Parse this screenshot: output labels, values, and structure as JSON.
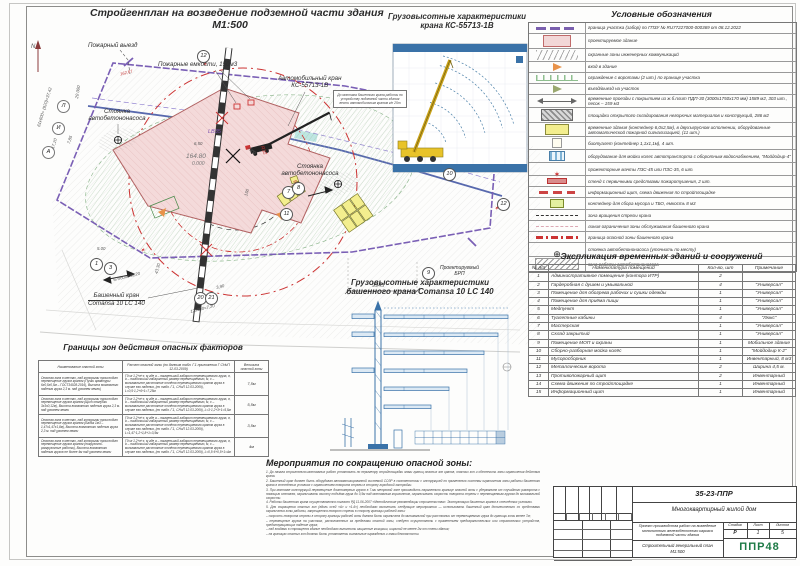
{
  "plan": {
    "title": "Стройгенплан на возведение подземной части здания",
    "scale": "М1:500",
    "labels": {
      "fire_exit": "Пожарный выезд",
      "fire_tanks": "Пожарные емкости, 150м3",
      "auto_crane_1": "Автомобильный кран",
      "auto_crane_2": "КС-55713-1В",
      "pump_parking_1": "Стоянка",
      "pump_parking_2": "автобетононасоса",
      "pump_parking2_1": "Стоянка",
      "pump_parking2_2": "автобетононасоса",
      "tower_crane_1": "Башенный кран",
      "tower_crane_2": "Comansa 10 LC 140",
      "brp_1": "Проектируемый",
      "brp_2": "БРП",
      "note": "До монтажа башенного крана работы по устройству подземной части здания вести автомобильным краном г/п 25т"
    },
    "marks": {
      "elev": "164.80",
      "zero": "0.000",
      "lb": "LB35",
      "r1": "R32",
      "r2": "R49,5",
      "red_elev": "162,67",
      "rail_len": "150"
    },
    "dims": {
      "d1": "61х600+ (920)=37,42",
      "d2": "20 000",
      "d3": "17,20",
      "d4": "9,40",
      "d5": "7,85",
      "d6": "5.00",
      "d7": "67х600=40,20",
      "d8": "43,30",
      "d9": "3,90",
      "d10": "12х600=7,20",
      "d11": "9945",
      "d12": "6,50",
      "d13": "7500"
    },
    "bubbles": {
      "n12": "12",
      "n10": "10",
      "n9": "9",
      "n11": "11",
      "n7": "7",
      "n8": "8",
      "n1": "1",
      "n3": "3",
      "n20": "20",
      "n21": "21",
      "axis_a": "А",
      "axis_i": "И",
      "axis_l": "Л"
    }
  },
  "truck_chart": {
    "title1": "Грузовысотные характеристики",
    "title2": "крана КС-55713-1В"
  },
  "tower_chart": {
    "title1": "Грузовысотные характеристики",
    "title2": "башенного крана Comansa 10 LC 140"
  },
  "legend": {
    "title": "Условные обозначения",
    "rows": [
      {
        "sym": "sym-boundary",
        "text": "граница участка (забор) по ГПЗУ № RU77227000-000369 от 08.12.2022"
      },
      {
        "sym": "sym-building",
        "text": "проектируемое здание"
      },
      {
        "sym": "sym-utility",
        "text": "охранные зоны инженерных коммуникаций"
      },
      {
        "sym": "sym-entry",
        "text": "вход в здание"
      },
      {
        "sym": "sym-fence",
        "text": "ограждение с воротами (2 шт.) по границе участка"
      },
      {
        "sym": "sym-exit",
        "text": "въезд/выезд на участок"
      },
      {
        "sym": "sym-roads",
        "text": "временные проезды с покрытием из ж.б.плит ПДП-30 (3000х1750х170 мм) 1589 м2, 303 шт., песок – 159 м3"
      },
      {
        "sym": "sym-storage",
        "text": "площадки открытого складирования негорючих материалов и конструкций, 286 м2"
      },
      {
        "sym": "sym-tempbld",
        "text": "временные здания (контейнер 6,0х2,5м), в двухъярусном исполнении, оборудованные автоматической пожарной сигнализацией, (11 шт.)"
      },
      {
        "sym": "sym-biotoilet",
        "text": "биотуалет (контейнер 1,1х1,1м), 4 шт."
      },
      {
        "sym": "sym-wash",
        "text": "оборудование для мойки колес автотранспорта с оборотным водоснабжением, \"Мойдодыр-4\""
      },
      {
        "sym": "sym-light",
        "text": "прожекторные мачты ПЗС-45 или ПЗС-35, 6 шт."
      },
      {
        "sym": "sym-firestand",
        "text": "стенд с первичными средствами пожаротушения, 2 шт."
      },
      {
        "sym": "sym-info",
        "text": "информационный щит, схема движения по стройплощадке"
      },
      {
        "sym": "sym-waste",
        "text": "контейнер для сбора мусора и ТБО, емкость 8 м3"
      },
      {
        "sym": "sym-slew",
        "text": "зона вращения стрелы крана"
      },
      {
        "sym": "sym-limit",
        "text": "линия ограничения зоны обслуживания башенного крана"
      },
      {
        "sym": "sym-danger",
        "text": "граница опасной зоны башенного крана"
      },
      {
        "sym": "sym-pumppark",
        "text": "стоянка автобетононасоса (уточнить по месту)"
      },
      {
        "sym": "sym-pumpzone",
        "text": "зона работы автобетононасоса"
      }
    ]
  },
  "explication": {
    "title": "Экспликация временных зданий и сооружений",
    "headers": [
      "№ п/п",
      "Номенклатура помещений",
      "Кол-во, шт",
      "Примечание"
    ],
    "rows": [
      {
        "num": "1",
        "name": "Административное помещение (контора ИТР)",
        "qty": "2",
        "note": ""
      },
      {
        "num": "2",
        "name": "Гардеробная с душем и умывальной",
        "qty": "4",
        "note": "\"Универсал\""
      },
      {
        "num": "3",
        "name": "Помещение для обогрева рабочих и сушки одежды",
        "qty": "1",
        "note": "\"Универсал\""
      },
      {
        "num": "4",
        "name": "Помещение для приёма пищи",
        "qty": "1",
        "note": "\"Универсал\""
      },
      {
        "num": "5",
        "name": "Медпункт",
        "qty": "1",
        "note": "\"Универсал\""
      },
      {
        "num": "6",
        "name": "Туалетные кабины",
        "qty": "4",
        "note": "\"Люкс\""
      },
      {
        "num": "7",
        "name": "Мастерская",
        "qty": "1",
        "note": "\"Универсал\""
      },
      {
        "num": "8",
        "name": "Склад закрытый",
        "qty": "1",
        "note": "\"Универсал\""
      },
      {
        "num": "9",
        "name": "Помещение МОП и охраны",
        "qty": "1",
        "note": "Мобильное здание"
      },
      {
        "num": "10",
        "name": "Сборно-разборная мойка колёс",
        "qty": "1",
        "note": "\"Мойдодыр К-2\""
      },
      {
        "num": "11",
        "name": "Мусоросборник",
        "qty": "1",
        "note": "Инвентарный, 8 м3"
      },
      {
        "num": "12",
        "name": "Металлические ворота",
        "qty": "2",
        "note": "Ширина 4,5 м."
      },
      {
        "num": "13",
        "name": "Противопожарный щит",
        "qty": "2",
        "note": "Инвентарный"
      },
      {
        "num": "14",
        "name": "Схема движения по стройплощадке",
        "qty": "1",
        "note": "Инвентарный"
      },
      {
        "num": "15",
        "name": "Информационный щит",
        "qty": "1",
        "note": "Инвентарный"
      }
    ]
  },
  "hazard_table": {
    "title": "Границы зон действия опасных факторов",
    "headers": [
      "Наименование опасной зоны",
      "Расчет опасной зоны (по данным табл. Г.1 приложения Г СНиП 12-03-2009)",
      "Величина опасной зоны"
    ],
    "rows": [
      {
        "name": "Опасная зона в местах, над которыми происходит перемещение грузов краном (Пучки арматуры 6х0,5х0,5м – ГОСТ34028-2016), Высота возможного падения груза 2,3 м. над уровнем земли)",
        "calc": "Г0=а·1,2+в+х, м  где а – наименьший габарит перемещаемого груза, в, b – наибольший габаритный размер перемещаемого, м, х – минимальное расстояние отлёта перемещаемого краном груза в случае его падения, (по табл. Г.1, СНиП 12-03-2009), L=0,5·1,2+6+1=7,25м",
        "value": "7,5м"
      },
      {
        "name": "Опасная зона в местах, над которыми происходит перемещение грузов краном (Щит опалубки 3х3х0,12м), Высота возможного падения груза 2,3 м. над уровнем земли",
        "calc": "Г0=а·1,2+в+х, м  где а – наименьший габарит перемещаемого груза, в, b – наибольший габаритный размер перемещаемого, м, х – минимальное расстояние отлёта перемещаемого краном груза в случае его падения, (по табл. Г.1, СНиП 12-03-2009), L=3·1,2+3+1=5,5м",
        "value": "5,5м"
      },
      {
        "name": "Опасная зона в местах, над которыми происходит перемещение грузов краном (Бадья 1м3 – 1,47х1,47х1,8м), Высота возможного падения груза 2,3 м. над уровнем земли",
        "calc": "Г0=а·1,2+в+х, м  где а – наименьший габарит перемещаемого груза, в, b – наибольший габаритный размер перемещаемого, м, х – минимальное расстояние отлёта перемещаемого краном груза в случае его падения, (по табл. Г.1, СНиП 12-03-2009), L=1,47·1,2+1,8+1=3,5м",
        "value": "3,5м"
      },
      {
        "name": "Опасная зона в местах, над которыми происходит перемещение грузов краном (погрузочно-разгрузочные работы), Высота возможного падения грузов не более 4м над уровнем земли",
        "calc": "Г0=а·1,2+в+х, м  где а – наименьший габарит перемещаемого груза, в, b – наибольший габаритный размер перемещаемого, м, х – минимальное расстояние отлёта перемещаемого краном груза в случае его падения, (по табл. Г.1, СНиП 12-03-2009), L=0,5·6+0,5+1=4м",
        "value": "4м"
      }
    ]
  },
  "measures": {
    "title": "Мероприятия по сокращению опасной зоны:",
    "items": [
      "1.   До начала строительно-монтажных работ установить по периметру стройплощадки знаки границ опасных зон кранов, опасных зон и обеспечить зоны ограничения действия крана.",
      "2.   Башенный кран должен быть оборудован автоматизированной системой СОЗР в соответствии с инструкцией по применению системы ограничения зоны работы башенного крана в стеснённых условиях с ограничением поворота стрелы в сторону городской застройки.",
      "3.   При монтаже конструкций перемещение длинномерных грузов в 7-ми метровой зоне производить параллельно границе опасной зоны с удержанием от случайного разворота с помощью оттяжек, ограничивать высоту подъёма груза до 0,5м над монтажным горизонтом, ограничивать скорость поворота стрелы с перемещаемым грузом до минимальной скорости.",
      "4.   Работы башенного крана осуществляются согласно РД 11-06-2007 «Методические рекомендации строительства». Эксплуатация башенных кранов в стеснённых условиях.",
      "5.   Для сокращения опасных зон (вдоль осей «А» и «1-6») необходимо выполнить следующие мероприятия — использовать башенный кран дополнительно со средствами ограничения зоны работы, запрещается поворот стрелы в сторону границы рабочей зоны:",
      "–  скорость поворота стрелы в сторону границы рабочей зоны должна быть ограничена до минимальной при расстоянии от перемещаемого груза до границы зоны менее 7м;",
      "–  перемещение грузов на участках, расположенных за пределами опасной зоны, следует осуществлять с применением предохранительных или страховочных устройств, предотвращающих падение груза;",
      "–  над входами в строящееся здание необходимо выполнить защитные козырьки, шириной не менее 2м от стены здания;",
      "–  на границах опасных зон должны быть установлены сигнальные ограждения и знаки безопасности."
    ]
  },
  "stamp": {
    "doc_code": "35-23-ППР",
    "object": "Многоквартирный жилой дом",
    "project_1": "Проект производства работ на возведение",
    "project_2": "монолитного железобетонного каркаса",
    "project_3": "подземной части здания",
    "stage_label": "Стадия",
    "sheet_label": "Лист",
    "sheets_label": "Листов",
    "stage": "Р",
    "sheet": "1",
    "sheets": "5",
    "drawing_1": "Строительный генеральный план",
    "drawing_2": "М1:500",
    "logo": "ППР48",
    "cols": [
      "Изм.",
      "Кол.уч",
      "Лист",
      "№док",
      "Подпись",
      "Дата"
    ],
    "roles": [
      "Разработал",
      "Проверил",
      "Гл.спец.",
      "Н.контр."
    ]
  }
}
